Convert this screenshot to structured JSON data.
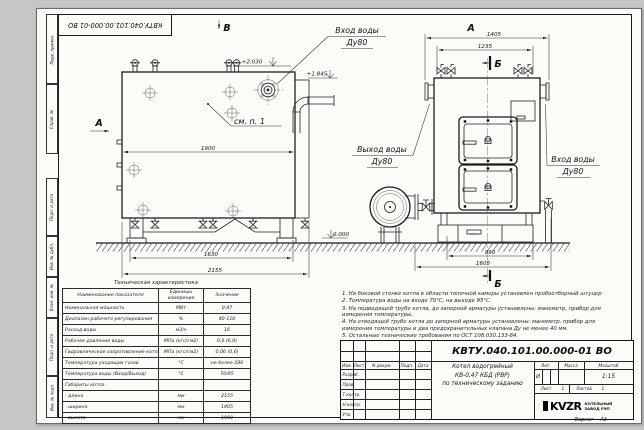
{
  "title_block": {
    "designation": "КВТУ.040.101.00.000-01 ВО",
    "product_lines": [
      "Котел водогрейный",
      "КВ-0,47 КБД (РВР)",
      "по техническому заданию"
    ],
    "cols": [
      "Изм.",
      "Лист",
      "N докум.",
      "Подп.",
      "Дата"
    ],
    "rows": [
      "Разраб.",
      "Пров.",
      "Т.контр.",
      "Н.контр.",
      "Утв."
    ],
    "lit_label": "Лит.",
    "lit_value": "И",
    "mass_label": "Масса",
    "scale_label": "Масштаб",
    "scale_value": "1:15",
    "sheet_label": "Лист",
    "sheet_value": "1",
    "sheets_label": "Листов",
    "sheets_value": "1",
    "company": {
      "logo": "KVZR",
      "line1": "КОТЕЛЬНЫЙ",
      "line2": "ЗАВОД РЭП"
    },
    "format_label": "Формат",
    "format_value": "А3"
  },
  "margin_labels": [
    "Перв. примен.",
    "Справ. №",
    "Подп. и дата",
    "Инв. № дубл.",
    "Взам. инв. №",
    "Подп. и дата",
    "Инв. № подл."
  ],
  "drawing": {
    "view_labels": {
      "a": "А",
      "b": "В",
      "section": "Б"
    },
    "note_ref": "см. п. 1",
    "elevations": {
      "top": "+2.030",
      "pipe": "+1.845",
      "ground": "0.000"
    },
    "dims_front": {
      "width": "1900",
      "base": "1630",
      "total": "2155"
    },
    "dims_side": {
      "total": "1405",
      "inner": "1235",
      "base": "990",
      "overall": "1605"
    },
    "labels": {
      "inlet_top": [
        "Вход воды",
        "Ду80"
      ],
      "outlet": [
        "Выход воды",
        "Ду80"
      ],
      "inlet_side": [
        "Вход воды",
        "Ду80"
      ]
    }
  },
  "tech_table": {
    "title": "Техническая характеристика",
    "headers": [
      "Наименование показателя",
      "Единицы измерения",
      "Значение"
    ],
    "rows": [
      {
        "name": "Номинальная мощность",
        "unit": "МВт",
        "value": "0,47"
      },
      {
        "name": "Диапазон рабочего регулирования",
        "unit": "%",
        "value": "40-110"
      },
      {
        "name": "Расход воды",
        "unit": "м3/ч",
        "value": "16"
      },
      {
        "name": "Рабочее давление воды",
        "unit": "МПа (кгс/см2)",
        "value": "0,6 (6,0)"
      },
      {
        "name": "Гидравлическое сопротивление котла",
        "unit": "МПа (кгс/см2)",
        "value": "0,06 (0,6)"
      },
      {
        "name": "Температура уходящих газов",
        "unit": "°С",
        "value": "не более 280"
      },
      {
        "name": "Температура воды (Вход/Выход)",
        "unit": "°С",
        "value": "70/95"
      },
      {
        "name": "Габариты котла",
        "unit": "",
        "value": ""
      },
      {
        "name": "- длина",
        "unit": "мм",
        "value": "2155"
      },
      {
        "name": "- ширина",
        "unit": "мм",
        "value": "1405"
      },
      {
        "name": "- высота",
        "unit": "мм",
        "value": "1900"
      }
    ]
  },
  "notes": [
    "1. На боковой стенке котла в области топочной камеры установлен пробоотборный штуцер",
    "2. Температура воды на входе 70°С, на выходе 95°С.",
    "3. На подводящей трубе котла, до запорной арматуры установлены: манометр, прибор для измерения температуры.",
    "4. На отводящей трубе котла до запорной арматуры установлены: манометр, прибор для измерения температуры и два предохранительных клапана  Ду не менее 40 мм.",
    "5. Остальные технические требования по ОСТ 108.030.133-84."
  ]
}
